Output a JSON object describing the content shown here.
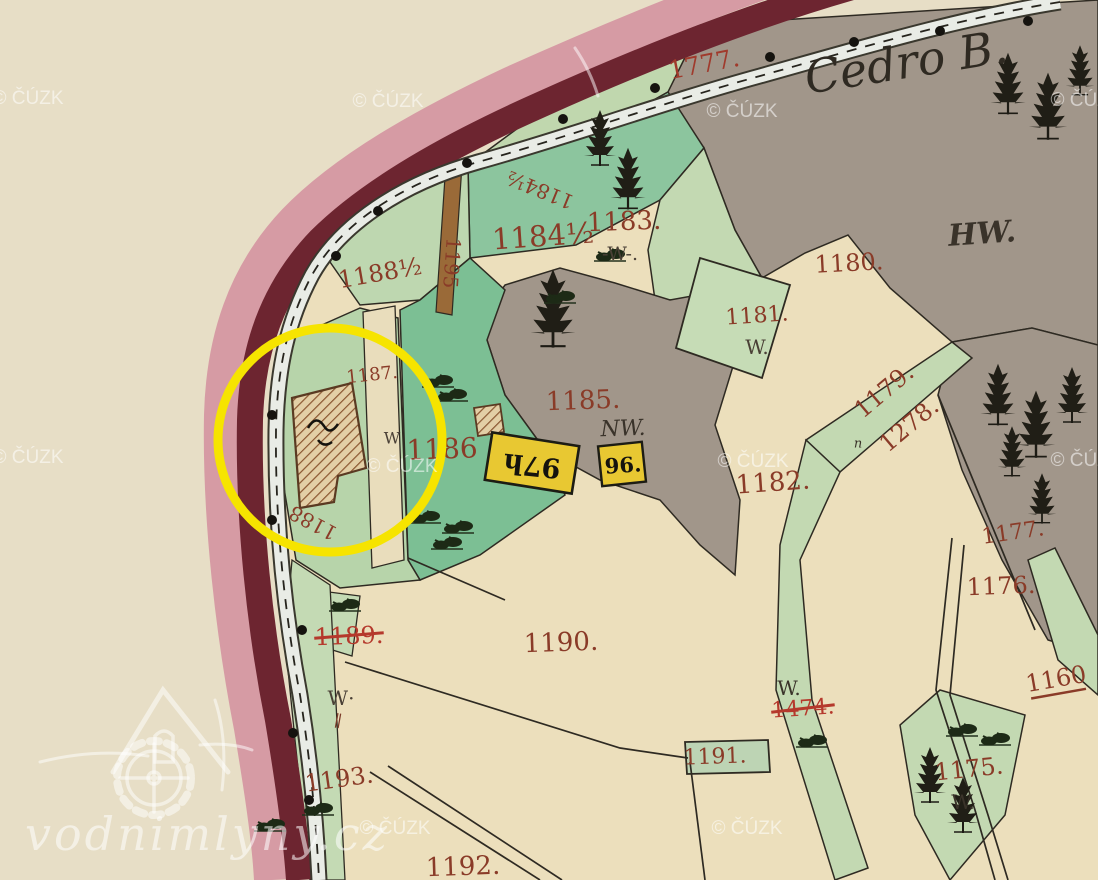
{
  "map": {
    "title_label": "Cedro B.",
    "watermark_text": "© ČÚZK",
    "logo_text": "vodnimlyny.cz",
    "colors": {
      "paper": "#e7dec6",
      "field_beige": "#ecdfbc",
      "forest_gray": "#a1968a",
      "meadow_light_green": "#c0d7ae",
      "meadow_teal": "#85c49c",
      "garden_green": "#7cbf94",
      "border_pink": "#d69ba4",
      "border_maroon": "#6d2530",
      "road_fill": "#e9ece6",
      "path_brown": "#9a6a38",
      "label_red_brown": "#8a3b28",
      "struck_red": "#b5392c",
      "building_yellow": "#e8c832",
      "annotation_yellow": "#f6e400",
      "tree_black": "#201e16"
    },
    "annotation": {
      "shape": "circle",
      "cx": 330,
      "cy": 440,
      "r": 112,
      "stroke": "#f6e400",
      "stroke_width": 9
    },
    "labels": [
      {
        "name": "map-title-cedro",
        "text": "Cedro B.",
        "x": 906,
        "y": 62,
        "size": 46,
        "rot": -9,
        "color": "#2f2a22",
        "italic": true
      },
      {
        "name": "road-number-1777",
        "text": "1777.",
        "x": 704,
        "y": 64,
        "size": 25,
        "rot": -11,
        "color": "#a03a2c"
      },
      {
        "name": "landuse-hw",
        "text": "HW.",
        "x": 982,
        "y": 234,
        "size": 30,
        "rot": -4,
        "color": "#3a332a",
        "italic": true,
        "bold": true
      },
      {
        "name": "parcel-label-1184-half-a",
        "text": "1184½",
        "x": 540,
        "y": 190,
        "size": 20,
        "rot": -158,
        "color": "#8a3b28"
      },
      {
        "name": "parcel-label-1184-half-b",
        "text": "1184½",
        "x": 543,
        "y": 236,
        "size": 29,
        "rot": -4,
        "color": "#8a3b28"
      },
      {
        "name": "parcel-label-1183",
        "text": "1183.",
        "x": 624,
        "y": 222,
        "size": 26,
        "rot": -2,
        "color": "#8a3b28"
      },
      {
        "name": "landuse-w-1183",
        "text": "-W-.",
        "x": 620,
        "y": 254,
        "size": 19,
        "rot": 0,
        "color": "#4a4036"
      },
      {
        "name": "parcel-label-1188-half",
        "text": "1188½",
        "x": 380,
        "y": 273,
        "size": 24,
        "rot": -10,
        "color": "#8a3b28"
      },
      {
        "name": "parcel-label-1180",
        "text": "1180.",
        "x": 849,
        "y": 263,
        "size": 24,
        "rot": -3,
        "color": "#8a3b28"
      },
      {
        "name": "parcel-label-1181",
        "text": "1181.",
        "x": 757,
        "y": 316,
        "size": 22,
        "rot": -4,
        "color": "#8a3b28"
      },
      {
        "name": "landuse-w-1181",
        "text": "W.",
        "x": 757,
        "y": 347,
        "size": 20,
        "rot": 0,
        "color": "#4a4036"
      },
      {
        "name": "parcel-label-1179",
        "text": "1179.",
        "x": 884,
        "y": 391,
        "size": 24,
        "rot": -40,
        "color": "#8a3b28"
      },
      {
        "name": "parcel-label-1278",
        "text": "1278.",
        "x": 909,
        "y": 425,
        "size": 24,
        "rot": -40,
        "color": "#8a3b28"
      },
      {
        "name": "parcel-label-1187",
        "text": "1187.",
        "x": 372,
        "y": 375,
        "size": 18,
        "rot": -6,
        "color": "#8a3b28"
      },
      {
        "name": "landuse-w-mill",
        "text": "W",
        "x": 392,
        "y": 438,
        "size": 16,
        "rot": 0,
        "color": "#4a4036"
      },
      {
        "name": "parcel-label-1186",
        "text": "1186",
        "x": 442,
        "y": 449,
        "size": 28,
        "rot": -2,
        "color": "#8a3b28"
      },
      {
        "name": "parcel-label-1185",
        "text": "1185.",
        "x": 583,
        "y": 401,
        "size": 26,
        "rot": -2,
        "color": "#8a3b28"
      },
      {
        "name": "landuse-nw-1185",
        "text": "NW.",
        "x": 623,
        "y": 429,
        "size": 22,
        "rot": -2,
        "color": "#3a332a",
        "italic": true
      },
      {
        "name": "parcel-label-1182",
        "text": "1182.",
        "x": 773,
        "y": 483,
        "size": 26,
        "rot": -4,
        "color": "#8a3b28"
      },
      {
        "name": "parcel-label-1188",
        "text": "1188",
        "x": 313,
        "y": 523,
        "size": 20,
        "rot": -152,
        "color": "#8a3b28"
      },
      {
        "name": "parcel-label-1177",
        "text": "1177.",
        "x": 1013,
        "y": 533,
        "size": 22,
        "rot": -8,
        "color": "#8a3b28"
      },
      {
        "name": "parcel-label-1176",
        "text": "1176.",
        "x": 1001,
        "y": 586,
        "size": 24,
        "rot": -2,
        "color": "#8a3b28"
      },
      {
        "name": "parcel-label-1160",
        "text": "1160",
        "x": 1056,
        "y": 679,
        "size": 24,
        "rot": -10,
        "color": "#8a3b28",
        "underline": true
      },
      {
        "name": "parcel-label-1189-struck",
        "text": "1189.",
        "x": 349,
        "y": 636,
        "size": 24,
        "rot": -2,
        "color": "#b5392c",
        "struck": true
      },
      {
        "name": "parcel-label-1190",
        "text": "1190.",
        "x": 561,
        "y": 643,
        "size": 26,
        "rot": -2,
        "color": "#8a3b28"
      },
      {
        "name": "landuse-w-1190",
        "text": "W·",
        "x": 341,
        "y": 698,
        "size": 20,
        "rot": 0,
        "color": "#4a4036"
      },
      {
        "name": "hatch-mark",
        "text": "∥",
        "x": 338,
        "y": 721,
        "size": 16,
        "rot": 10,
        "color": "#7a3a28"
      },
      {
        "name": "landuse-w-1474",
        "text": "W.",
        "x": 789,
        "y": 688,
        "size": 20,
        "rot": 0,
        "color": "#3a332a"
      },
      {
        "name": "parcel-label-1474-struck",
        "text": "1474.",
        "x": 803,
        "y": 709,
        "size": 22,
        "rot": -4,
        "color": "#b5392c",
        "struck": true
      },
      {
        "name": "parcel-label-1191",
        "text": "1191.",
        "x": 715,
        "y": 757,
        "size": 22,
        "rot": -2,
        "color": "#8a3b28"
      },
      {
        "name": "parcel-label-1175",
        "text": "1175.",
        "x": 969,
        "y": 769,
        "size": 24,
        "rot": -6,
        "color": "#8a3b28"
      },
      {
        "name": "landuse-w-1175",
        "text": "W.",
        "x": 963,
        "y": 802,
        "size": 20,
        "rot": 0,
        "color": "#3a332a"
      },
      {
        "name": "parcel-label-1193",
        "text": "1193.",
        "x": 339,
        "y": 779,
        "size": 24,
        "rot": -8,
        "color": "#8a3b28"
      },
      {
        "name": "parcel-label-1192",
        "text": "1192.",
        "x": 463,
        "y": 867,
        "size": 26,
        "rot": -2,
        "color": "#8a3b28"
      },
      {
        "name": "road-number-1195",
        "text": "1195",
        "x": 452,
        "y": 263,
        "size": 20,
        "rot": 94,
        "color": "#8a3b28"
      },
      {
        "name": "small-letter-n",
        "text": "n",
        "x": 858,
        "y": 444,
        "size": 13,
        "rot": 0,
        "color": "#3a332a",
        "italic": true
      },
      {
        "name": "building-number-97h",
        "text": "97h",
        "x": 532,
        "y": 465,
        "size": 27,
        "rot": 186,
        "color": "#15130e",
        "bold": true
      },
      {
        "name": "building-number-96",
        "text": "96.",
        "x": 623,
        "y": 465,
        "size": 21,
        "rot": -4,
        "color": "#15130e",
        "bold": true
      }
    ],
    "watermarks": [
      {
        "x": 28,
        "y": 104
      },
      {
        "x": 388,
        "y": 107
      },
      {
        "x": 742,
        "y": 117
      },
      {
        "x": 1086,
        "y": 106
      },
      {
        "x": 28,
        "y": 463
      },
      {
        "x": 402,
        "y": 472
      },
      {
        "x": 753,
        "y": 467
      },
      {
        "x": 1086,
        "y": 466
      },
      {
        "x": 395,
        "y": 834
      },
      {
        "x": 747,
        "y": 834
      }
    ],
    "boundary_dots": [
      {
        "x": 563,
        "y": 119
      },
      {
        "x": 467,
        "y": 163
      },
      {
        "x": 378,
        "y": 211
      },
      {
        "x": 336,
        "y": 256
      },
      {
        "x": 272,
        "y": 415
      },
      {
        "x": 272,
        "y": 520
      },
      {
        "x": 302,
        "y": 630
      },
      {
        "x": 293,
        "y": 733
      },
      {
        "x": 309,
        "y": 800
      },
      {
        "x": 655,
        "y": 88
      },
      {
        "x": 770,
        "y": 57
      },
      {
        "x": 854,
        "y": 42
      },
      {
        "x": 940,
        "y": 31
      },
      {
        "x": 1028,
        "y": 21
      }
    ],
    "trees": [
      {
        "x": 600,
        "y": 162,
        "s": 1.0
      },
      {
        "x": 628,
        "y": 205,
        "s": 1.1
      },
      {
        "x": 553,
        "y": 342,
        "s": 1.4
      },
      {
        "x": 1008,
        "y": 110,
        "s": 1.1
      },
      {
        "x": 1048,
        "y": 135,
        "s": 1.2
      },
      {
        "x": 1080,
        "y": 92,
        "s": 0.9
      },
      {
        "x": 998,
        "y": 421,
        "s": 1.1
      },
      {
        "x": 1036,
        "y": 453,
        "s": 1.2
      },
      {
        "x": 1072,
        "y": 419,
        "s": 1.0
      },
      {
        "x": 1012,
        "y": 473,
        "s": 0.9
      },
      {
        "x": 1042,
        "y": 520,
        "s": 0.9
      },
      {
        "x": 930,
        "y": 799,
        "s": 1.0
      },
      {
        "x": 963,
        "y": 829,
        "s": 1.0
      }
    ],
    "bushes": [
      {
        "x": 452,
        "y": 398
      },
      {
        "x": 438,
        "y": 384
      },
      {
        "x": 425,
        "y": 520
      },
      {
        "x": 447,
        "y": 546
      },
      {
        "x": 458,
        "y": 530
      },
      {
        "x": 345,
        "y": 608
      },
      {
        "x": 812,
        "y": 744
      },
      {
        "x": 962,
        "y": 733
      },
      {
        "x": 995,
        "y": 742
      },
      {
        "x": 318,
        "y": 812
      },
      {
        "x": 270,
        "y": 828
      },
      {
        "x": 560,
        "y": 300
      },
      {
        "x": 610,
        "y": 258
      }
    ]
  }
}
